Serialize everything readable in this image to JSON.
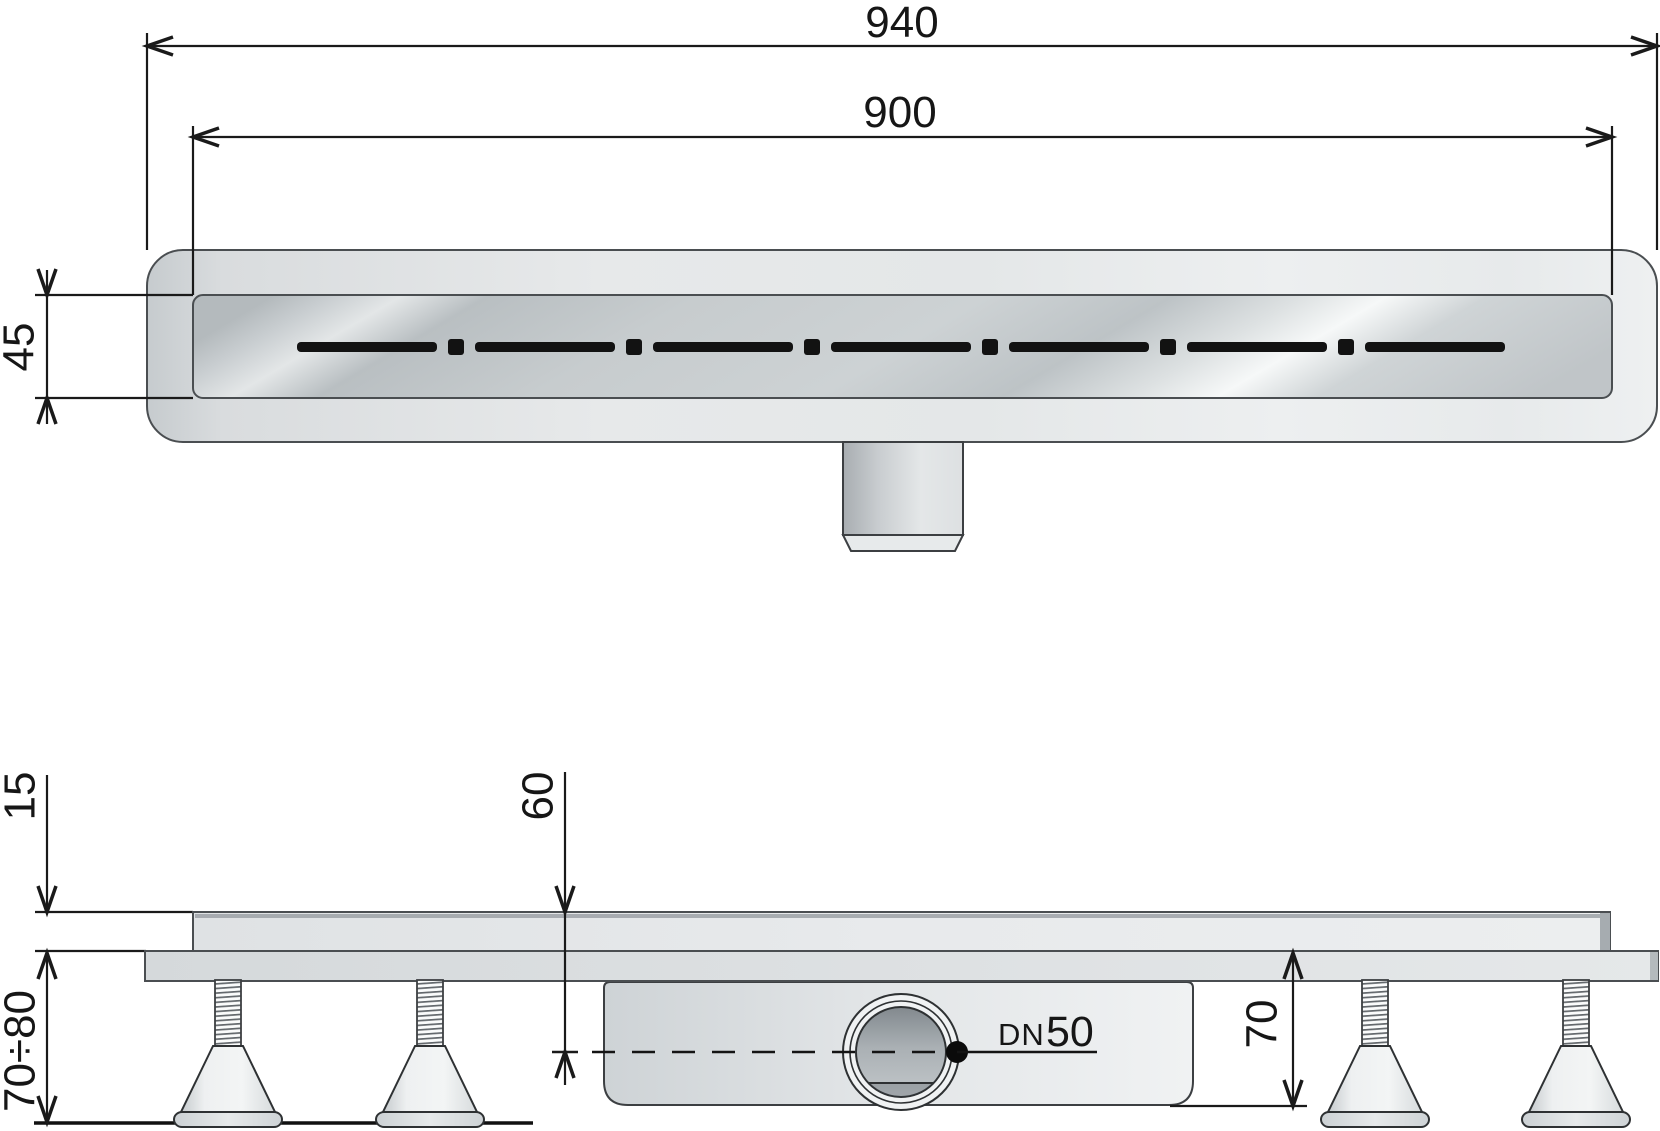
{
  "colors": {
    "background": "#ffffff",
    "dimension_line": "#1a1a1a",
    "part_outline": "#44484b",
    "body_gray": "#e6e9ea",
    "metal_dark": "#b2b8bb",
    "metal_light": "#f5f7f7",
    "slot_black": "#121212"
  },
  "top_view": {
    "length_overall": "940",
    "length_inner": "900",
    "width": "45"
  },
  "side_view": {
    "top_thickness": "15",
    "depth_to_axis": "60",
    "height_range": "70÷80",
    "body_height": "70",
    "outlet_prefix": "DN",
    "outlet_size": "50"
  }
}
